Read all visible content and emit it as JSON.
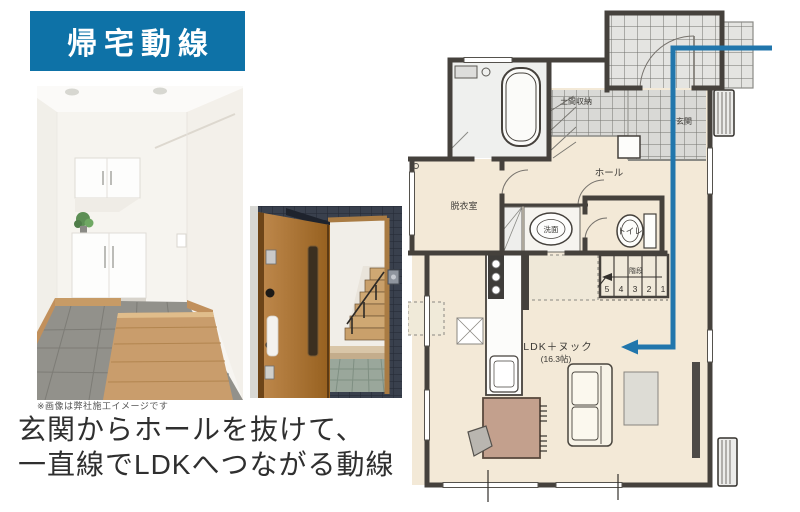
{
  "badge": {
    "label": "帰宅動線"
  },
  "caption": {
    "line1": "玄関からホールを抜けて、",
    "line2": "一直線でLDKへつながる動線"
  },
  "disclaimer": "※画像は弊社施工イメージです",
  "colors": {
    "badge_bg": "#0e72a7",
    "route": "#2176ac",
    "caption_text": "#2f2f2f"
  },
  "floorplan": {
    "labels": {
      "doma": "土間収納",
      "hall": "ホール",
      "genkan": "玄関",
      "dressing": "脱衣室",
      "washstand": "洗面",
      "toilet": "トイレ",
      "stairs": "階段",
      "ldk": "LDK＋ヌック",
      "ldk_size": "(16.3帖)"
    },
    "stair_numbers": [
      "5",
      "4",
      "3",
      "2",
      "1"
    ]
  }
}
